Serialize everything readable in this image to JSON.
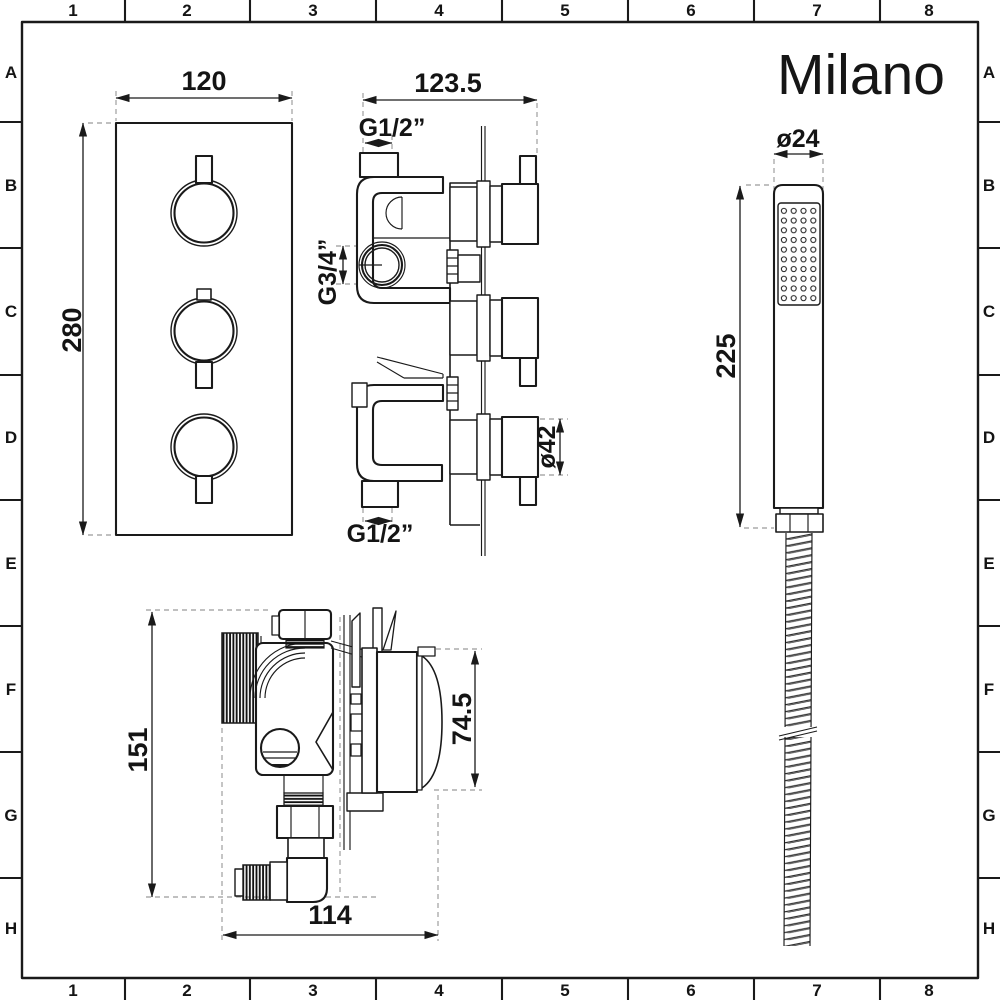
{
  "brand": {
    "logo": "Milano"
  },
  "frame": {
    "columns": [
      "1",
      "2",
      "3",
      "4",
      "5",
      "6",
      "7",
      "8"
    ],
    "rows": [
      "A",
      "B",
      "C",
      "D",
      "E",
      "F",
      "G",
      "H"
    ]
  },
  "views": {
    "front_panel": {
      "width_dim": "120",
      "height_dim": "280"
    },
    "valve_side": {
      "depth_dim": "123.5",
      "top_connection": "G1/2”",
      "side_connection": "G3/4”",
      "handle_diameter": "ø42",
      "bottom_connection": "G1/2”"
    },
    "hand_shower": {
      "head_diameter": "ø24",
      "length_dim": "225"
    },
    "valve_top": {
      "height_dim": "151",
      "cartridge_dim": "74.5",
      "width_dim": "114"
    }
  },
  "colors": {
    "ink": "#1a1a1a",
    "paper": "#ffffff",
    "extension_dash": "#9a9a9a"
  }
}
